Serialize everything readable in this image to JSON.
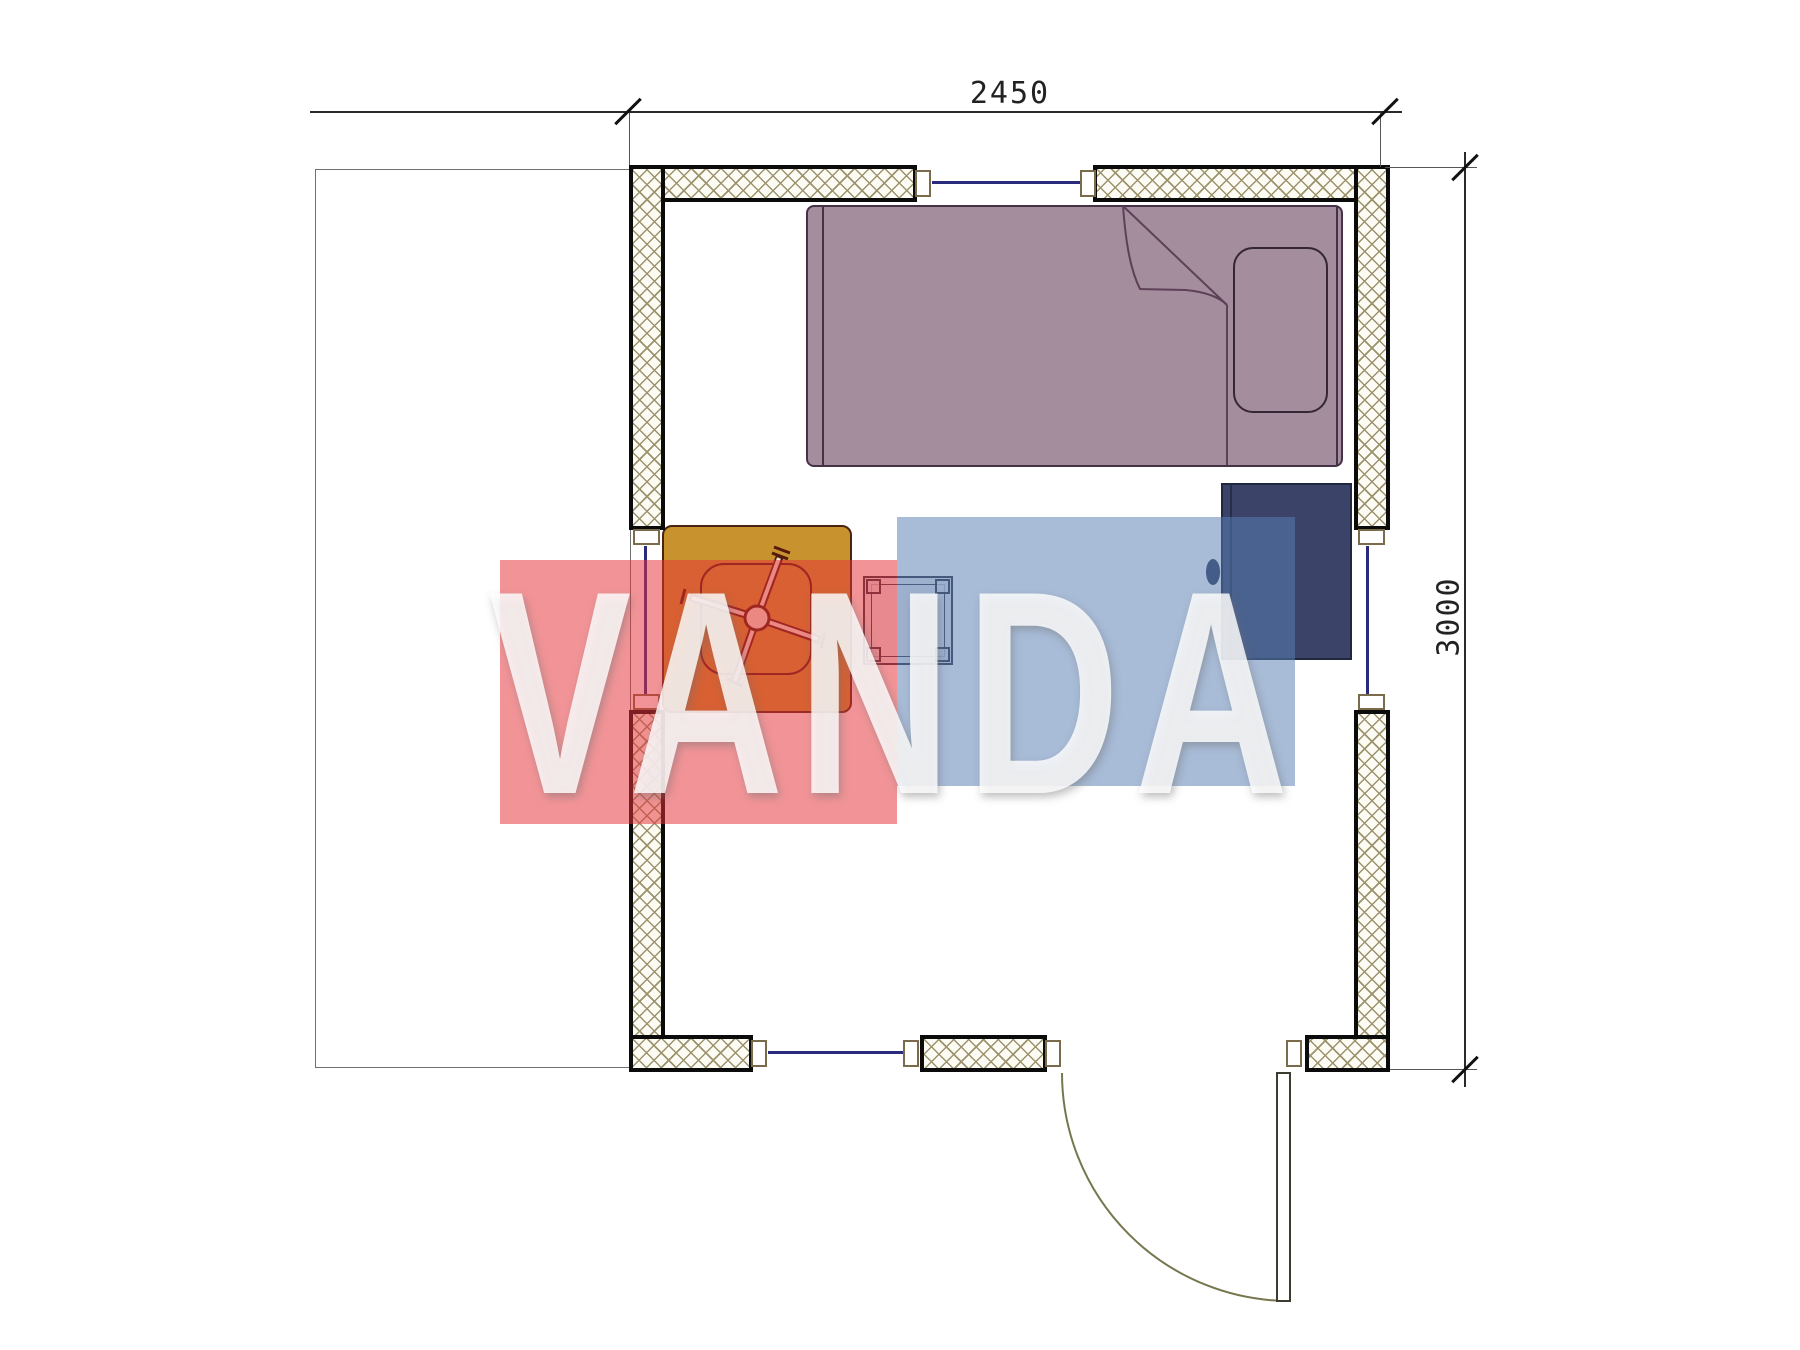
{
  "drawing": {
    "type": "architectural floor plan",
    "dimensions": {
      "width_label": "2450",
      "height_label": "3000"
    },
    "furniture": [
      {
        "name": "single-bed",
        "color": "#a48d9c"
      },
      {
        "name": "pillow",
        "color": "#a48d9c"
      },
      {
        "name": "wardrobe",
        "color": "#3b4468"
      },
      {
        "name": "desk",
        "color": "#c8922f"
      },
      {
        "name": "office-chair",
        "color": "#551a0c"
      },
      {
        "name": "stool-table",
        "color": "#9ba0b0"
      }
    ],
    "features": [
      "hatched-walls",
      "windows",
      "door-swing",
      "terrace-outline"
    ],
    "colors": {
      "wall_hatch": "#9c926c",
      "window_glass": "#2b2b7e",
      "dimension_lines": "#2a2a2a",
      "door_swing": "#77774f"
    }
  },
  "watermark": {
    "text": "VANDA",
    "red_block": "#e6323c",
    "blue_block": "#587eb4",
    "text_color": "#ffffff"
  }
}
